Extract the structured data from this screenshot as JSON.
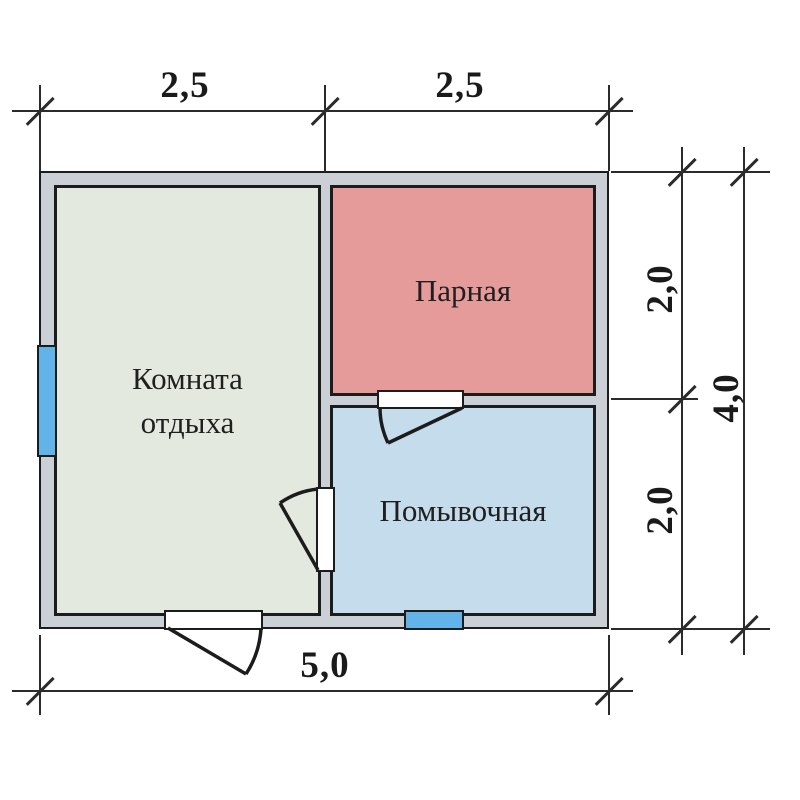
{
  "plan": {
    "type": "floor-plan",
    "rooms": [
      {
        "id": "rest",
        "label": "Комната отдыха",
        "fill": "#e4e9df"
      },
      {
        "id": "steam",
        "label": "Парная",
        "fill": "#e49b99"
      },
      {
        "id": "wash",
        "label": "Помывочная",
        "fill": "#c5dcec"
      }
    ],
    "dimensions": {
      "top": [
        {
          "value": "2,5"
        },
        {
          "value": "2,5"
        }
      ],
      "right": [
        {
          "value": "2,0"
        },
        {
          "value": "2,0"
        },
        {
          "value": "4,0"
        }
      ],
      "bottom": [
        {
          "value": "5,0"
        }
      ]
    },
    "features": {
      "windows": 2,
      "doors": 3
    },
    "colors": {
      "wall_fill": "#cbd0d6",
      "outline": "#1c1c1c",
      "window": "#62b4e8",
      "dimension_lines": "#2b2b2b"
    }
  }
}
